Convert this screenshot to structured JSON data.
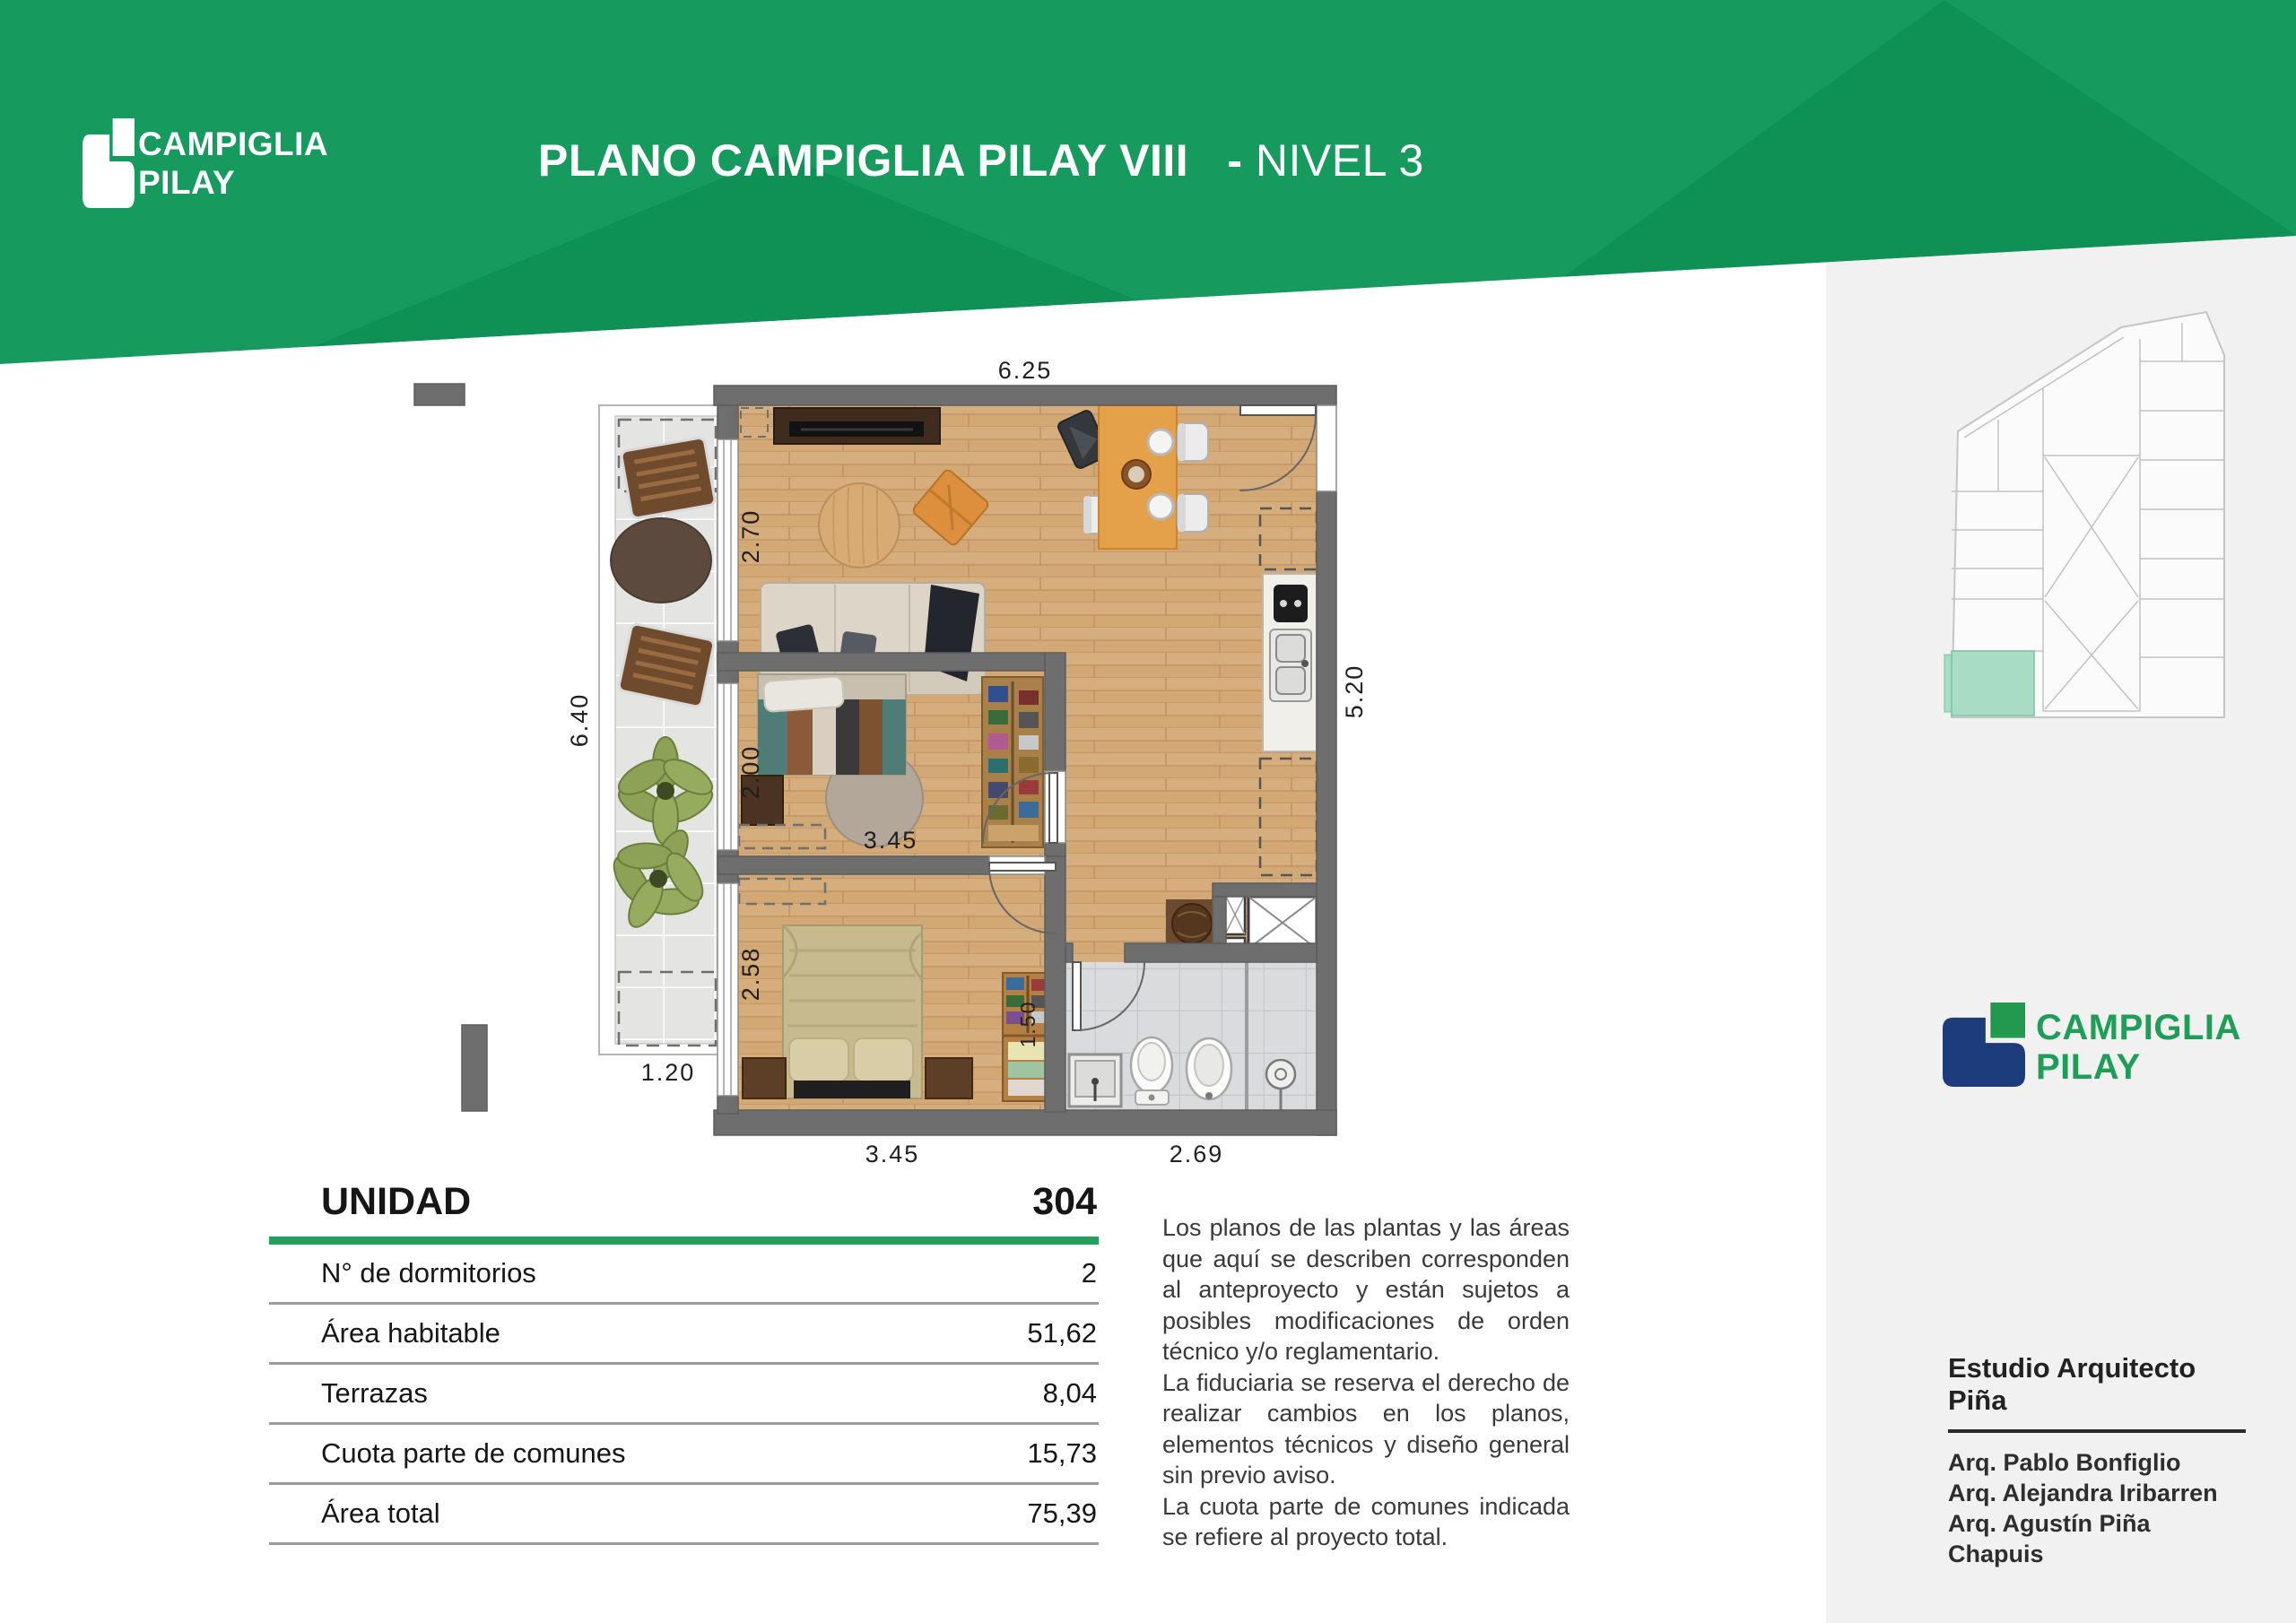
{
  "header": {
    "logo": {
      "line1": "CAMPIGLIA",
      "line2": "PILAY"
    },
    "title_bold": "PLANO CAMPIGLIA PILAY VIII",
    "title_sep": "-",
    "title_light": "NIVEL 3"
  },
  "plan": {
    "dims": {
      "top": "6.25",
      "right": "5.20",
      "left": "6.40",
      "living": "2.70",
      "bed1_h": "2.00",
      "bed1_w": "3.45",
      "bed2_h": "2.58",
      "closet": "1.50",
      "balcony_w": "1.20",
      "bottom_left": "3.45",
      "bottom_right": "2.69"
    }
  },
  "unit_table": {
    "title": "UNIDAD",
    "unit_number": "304",
    "rows": [
      {
        "label": "N° de dormitorios",
        "value": "2"
      },
      {
        "label": "Área habitable",
        "value": "51,62"
      },
      {
        "label": "Terrazas",
        "value": "8,04"
      },
      {
        "label": "Cuota parte de comunes",
        "value": "15,73"
      },
      {
        "label": "Área total",
        "value": "75,39"
      }
    ]
  },
  "disclaimer": {
    "p1": "Los planos de las plantas y las áreas que aquí se describen corresponden al anteproyecto y están sujetos a posibles modificaciones de orden técnico y/o reglamentario.",
    "p2": "La fiduciaria se reserva el derecho de realizar cambios en los planos, elementos técnicos y diseño general sin previo aviso.",
    "p3": "La cuota parte de comunes indicada se refiere al proyecto total."
  },
  "sidebar": {
    "logo": {
      "line1": "CAMPIGLIA",
      "line2": "PILAY"
    },
    "studio": {
      "title": "Estudio Arquitecto Piña",
      "architects": [
        "Arq. Pablo Bonfiglio",
        "Arq. Alejandra Iribarren",
        "Arq. Agustín Piña Chapuis"
      ]
    }
  },
  "colors": {
    "brand_green": "#169a5e",
    "brand_green_dark": "#0f9156",
    "logo_blue": "#1d3c7c",
    "logo_green": "#23994f",
    "table_rule_green": "#21a05e",
    "highlight_unit_mint": "#a9dcc4",
    "wall_gray": "#6e6e6e",
    "wood_floor": "#d2a875"
  }
}
